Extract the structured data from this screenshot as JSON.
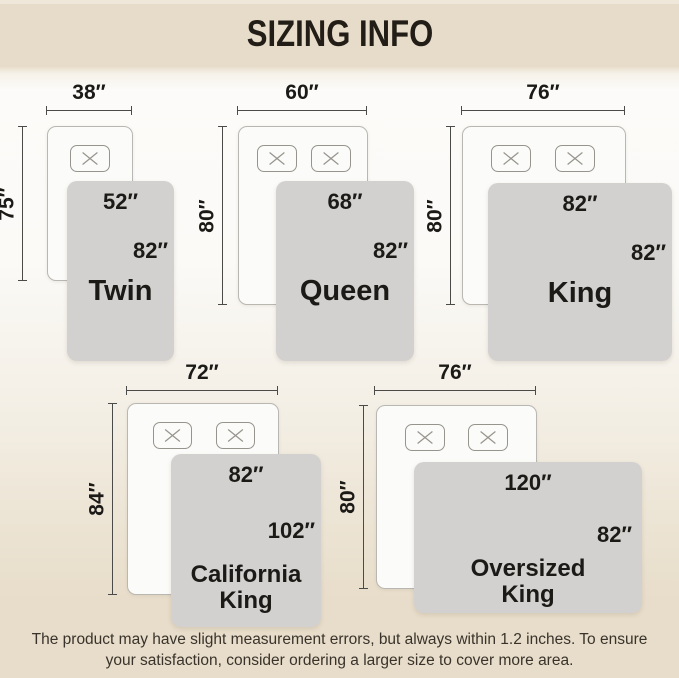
{
  "title": "SIZING INFO",
  "beds": [
    {
      "name": "Twin",
      "bed_width": "38″",
      "bed_length": "75″",
      "blanket_width": "52″",
      "blanket_length": "82″"
    },
    {
      "name": "Queen",
      "bed_width": "60″",
      "bed_length": "80″",
      "blanket_width": "68″",
      "blanket_length": "82″"
    },
    {
      "name": "King",
      "bed_width": "76″",
      "bed_length": "80″",
      "blanket_width": "82″",
      "blanket_length": "82″"
    },
    {
      "name": "California King",
      "bed_width": "72″",
      "bed_length": "84″",
      "blanket_width": "82″",
      "blanket_length": "102″"
    },
    {
      "name": "Oversized King",
      "bed_width": "76″",
      "bed_length": "80″",
      "blanket_width": "120″",
      "blanket_length": "82″"
    }
  ],
  "footer": {
    "disclaimer": "The product may have slight measurement errors, but always within 1.2 inches. To ensure your satisfaction, consider ordering a larger size to cover more area."
  },
  "colors": {
    "header_bg": "#e7dcc9",
    "blanket_gray": "#d3d1cf",
    "bed_fill": "#fbfbf9",
    "dimension_line": "#4a4a48",
    "text": "#1c1a17"
  }
}
